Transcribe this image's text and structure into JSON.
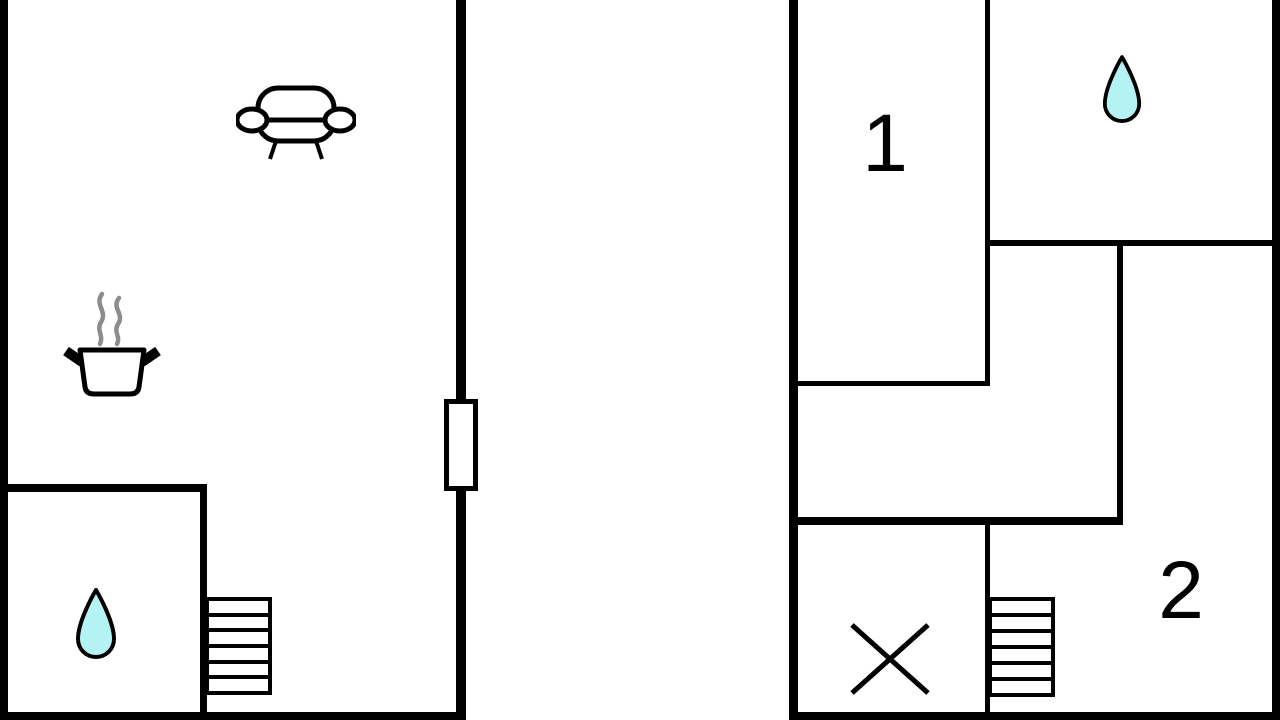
{
  "floorplan": {
    "title": "two-level floor plan",
    "background_color": "#ffffff",
    "wall_color": "#000000",
    "water_drop_color": "#b5f2f3",
    "steam_color": "#8c8c8c",
    "line_color": "#000000",
    "rooms": {
      "room1_label": "1",
      "room2_label": "2"
    },
    "icons": [
      "sofa-icon",
      "cooking-pot-icon",
      "water-drop-icon-left",
      "stairs-icon-left",
      "door-icon",
      "water-drop-icon-right",
      "stairs-icon-right",
      "cross-icon"
    ]
  }
}
